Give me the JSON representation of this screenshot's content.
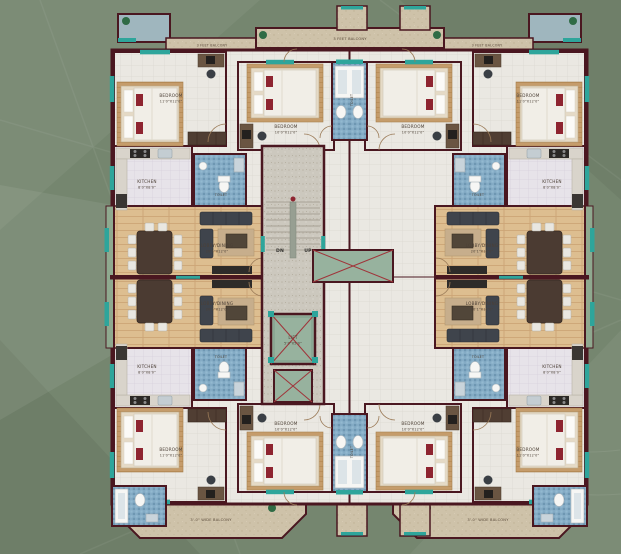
{
  "plan": {
    "type": "residential-floor-plan",
    "stairs": {
      "down": "DN",
      "up": "UP"
    },
    "rooms": {
      "bedroom_corner": {
        "name": "BEDROOM",
        "dims": "11'0\"X12'0\""
      },
      "bedroom_center": {
        "name": "BEDROOM",
        "dims": "10'0\"X12'0\""
      },
      "kitchen": {
        "name": "KITCHEN",
        "dims": "8'0\"X8'0\""
      },
      "toilet": {
        "name": "TOILET",
        "dims": "4'0\"X8'0\""
      },
      "toilet_small": {
        "name": "TOILET",
        "dims": "4'0\"X5'0\""
      },
      "lobby_dining": {
        "name": "LOBBY/DINING",
        "dims": "20'1\"X12'0\""
      },
      "lift": {
        "name": "LIFT",
        "dims": "5'0\"X5'0\""
      }
    },
    "balconies": {
      "feet3": "3 FEET BALCONY",
      "wide": "3'-0\" WIDE BALCONY"
    },
    "colors": {
      "background": "#75866F",
      "walls": "#4A1720",
      "wood_floor": "#DDBE90",
      "toilet_tile": "#84ABC5",
      "lift_green": "#97B29E",
      "window_teal": "#2EA59B",
      "bed_accent": "#8E2430",
      "balcony_floor": "#CEC2A9"
    }
  }
}
